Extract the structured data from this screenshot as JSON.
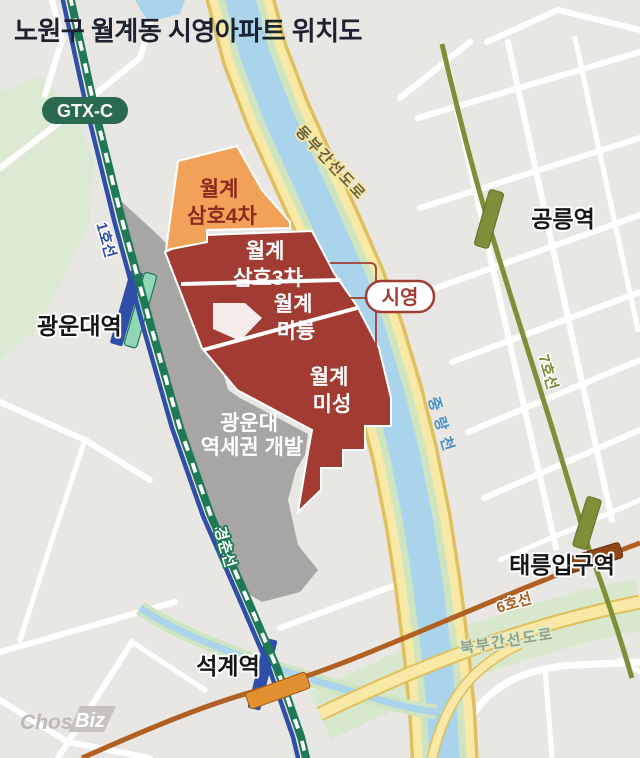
{
  "title": "노원구 월계동 시영아파트 위치도",
  "badges": {
    "gtx": "GTX-C"
  },
  "areas": {
    "samho4": {
      "lines": [
        "월계",
        "삼호4차"
      ],
      "color": "#f2a159",
      "text_color": "#8d2a1f"
    },
    "samho3": {
      "lines": [
        "월계",
        "삼호3차"
      ],
      "color": "#a23c33",
      "text_color": "#ffffff"
    },
    "miryung": {
      "lines": [
        "월계",
        "미륭"
      ],
      "color": "#a23c33",
      "text_color": "#ffffff"
    },
    "misung": {
      "lines": [
        "월계",
        "미성"
      ],
      "color": "#a23c33",
      "text_color": "#ffffff"
    },
    "redevelopment": {
      "lines": [
        "광운대",
        "역세권 개발"
      ],
      "color": "#a8a6a4",
      "text_color": "#ffffff"
    },
    "siyoung": {
      "label": "시영",
      "color": "#a23c33"
    }
  },
  "stations": {
    "gwangwoondae": "광운대역",
    "seokgye": "석계역",
    "gongneung": "공릉역",
    "taereung": "태릉입구역"
  },
  "transit_lines": {
    "line1": {
      "label": "1호선",
      "color": "#2e4ea8"
    },
    "gyeongchun": {
      "label": "경춘선",
      "color": "#1d7a55"
    },
    "line6": {
      "label": "6호선",
      "color": "#b06023"
    },
    "line7": {
      "label": "7호선",
      "color": "#7e8f3a"
    }
  },
  "roads": {
    "dongbu": "동부간선도로",
    "bukbu": "북부간선도로"
  },
  "river": {
    "name": "중랑천",
    "color": "#a9d4ec"
  },
  "logo": {
    "chosun": "Chosun",
    "biz": "Biz"
  },
  "colors": {
    "background": "#e9e7e4",
    "street": "#ffffff",
    "park": "#dcead4",
    "road_yellow": "#f9e9a6",
    "road_yellow_border": "#e2bf5e",
    "river_bank": "#cfe5c2",
    "rail_green": "#1d7a55",
    "title_text": "#1d2230"
  }
}
